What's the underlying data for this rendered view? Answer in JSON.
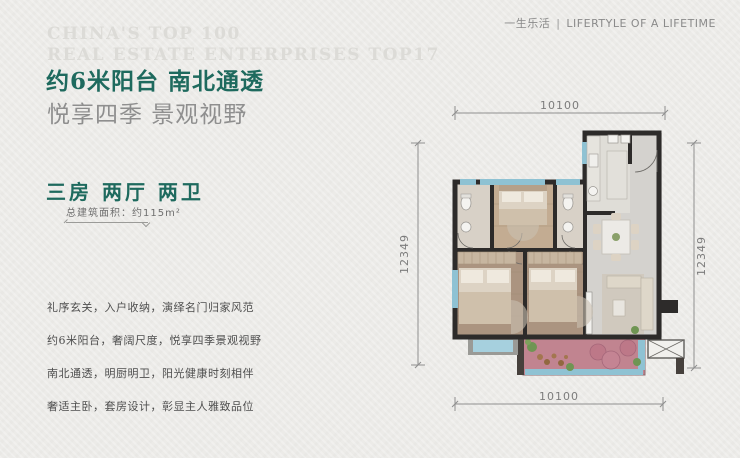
{
  "header": {
    "cn": "一生乐活",
    "sep": "|",
    "en": "LIFERTYLE OF A LIFETIME"
  },
  "watermark": {
    "line1": "CHINA'S TOP 100",
    "line2": "REAL ESTATE ENTERPRISES TOP17"
  },
  "headline": {
    "line1": "约6米阳台 南北通透",
    "line2": "悦享四季 景观视野"
  },
  "spec": {
    "rooms_title": "三房 两厅 两卫",
    "area": "总建筑面积：约115m²"
  },
  "features": [
    "礼序玄关，入户收纳，演绎名门归家风范",
    "约6米阳台，奢阔尺度，悦享四季景观视野",
    "南北通透，明厨明卫，阳光健康时刻相伴",
    "奢适主卧，套房设计，彰显主人雅致品位"
  ],
  "floorplan": {
    "dim_top": "10100",
    "dim_bottom": "10100",
    "dim_left": "12349",
    "dim_right": "12349"
  },
  "colors": {
    "bg": "#ecebe8",
    "teal": "#1e6a5e",
    "subtitle-gray": "#8f8f8f",
    "body-text": "#4e4e4e",
    "watermark": "#dcdbd7",
    "header-text": "#8a8a8a",
    "dim": "#8f8f8f",
    "wall": "#2d2b2a",
    "floor-living": "#d4d2ce",
    "floor-light": "#dfddd7",
    "floor-bath": "#d8d1c7",
    "wood": "#ab9480",
    "window-blue": "#8fc2d3",
    "balcony-pink": "#c18490",
    "furniture": "#ddd3c4"
  }
}
